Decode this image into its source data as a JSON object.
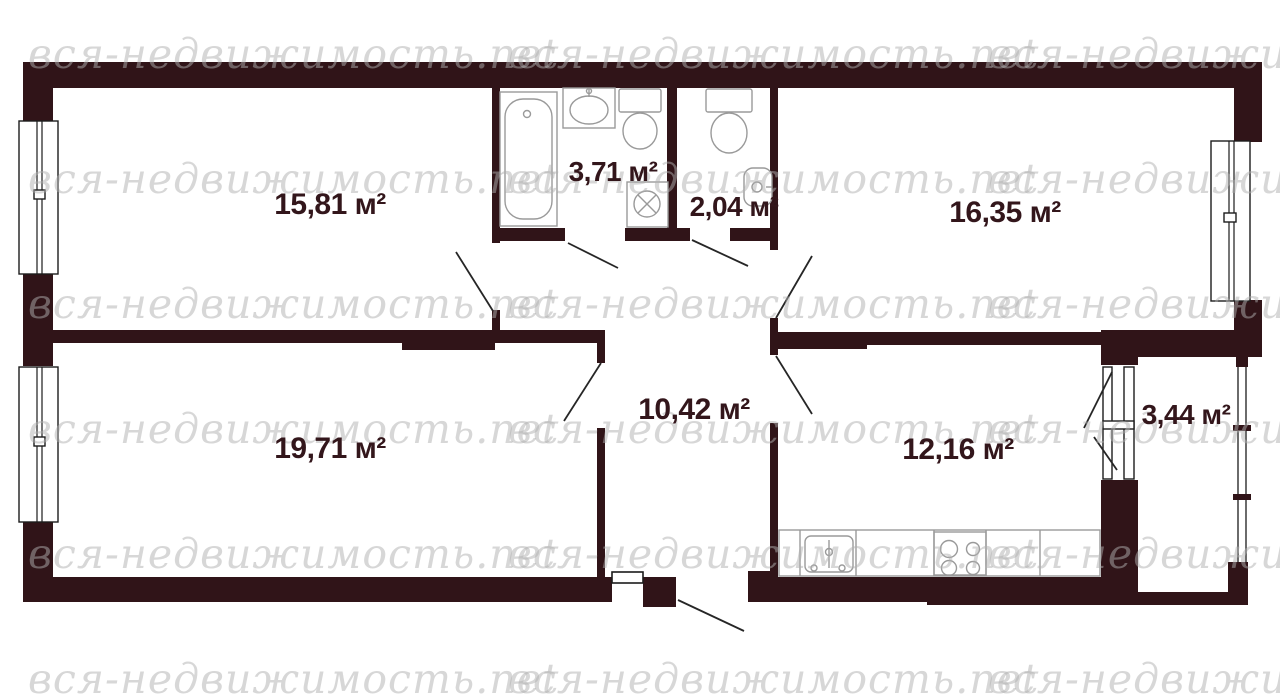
{
  "watermark": {
    "text": "вся-недвижимость.net",
    "color": "#b0b0b0",
    "cols": [
      28,
      508,
      988
    ],
    "rows": [
      34,
      159,
      284,
      409,
      534,
      659
    ]
  },
  "plan": {
    "wall_color": "#301418",
    "floor_color": "#ffffff",
    "label_color": "#33161b",
    "fixture_color": "#9a9a9a",
    "unit": "м²",
    "total_rooms": 8,
    "rooms": [
      {
        "id": "room-top-left",
        "area_label": "15,81 м²"
      },
      {
        "id": "bathroom",
        "area_label": "3,71 м²"
      },
      {
        "id": "wc",
        "area_label": "2,04 м²"
      },
      {
        "id": "room-top-right",
        "area_label": "16,35 м²"
      },
      {
        "id": "room-bottom-left",
        "area_label": "19,71 м²"
      },
      {
        "id": "hallway",
        "area_label": "10,42 м²"
      },
      {
        "id": "kitchen",
        "area_label": "12,16 м²"
      },
      {
        "id": "balcony",
        "area_label": "3,44 м²"
      }
    ]
  }
}
